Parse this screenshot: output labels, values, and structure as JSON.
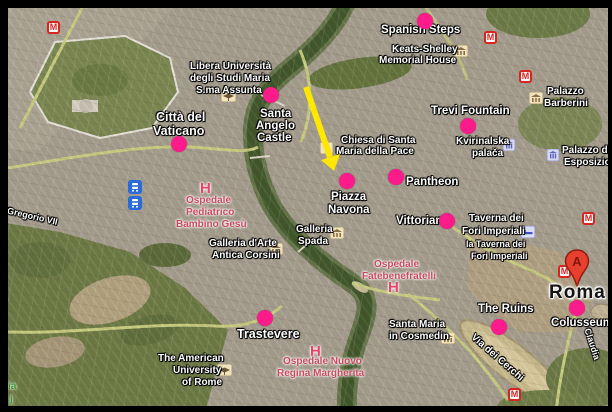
{
  "map": {
    "colors": {
      "marker": "#fb1b8b",
      "arrow": "#ffe800",
      "label": "#ffffff",
      "hospital": "#c84a5f",
      "hospital_h": "#e8436b",
      "park_label": "#3f9340",
      "metro": "#d62420",
      "city_label": "#151515"
    },
    "icon_glyphs": {
      "metro": "M",
      "pin": "A"
    },
    "dots": [
      {
        "name": "spanish-steps",
        "x": 425,
        "y": 21
      },
      {
        "name": "santa-angelo-castle",
        "x": 271,
        "y": 95
      },
      {
        "name": "trevi-fountain",
        "x": 468,
        "y": 126
      },
      {
        "name": "citta-del-vaticano",
        "x": 179,
        "y": 144
      },
      {
        "name": "piazza-navona",
        "x": 347,
        "y": 181
      },
      {
        "name": "pantheon",
        "x": 396,
        "y": 177
      },
      {
        "name": "vittoriano",
        "x": 447,
        "y": 221
      },
      {
        "name": "trastevere",
        "x": 265,
        "y": 318
      },
      {
        "name": "the-ruins",
        "x": 499,
        "y": 327
      },
      {
        "name": "colosseum",
        "x": 577,
        "y": 308
      }
    ],
    "labels": [
      {
        "text": "Spanish Steps",
        "x": 381,
        "y": 24,
        "cls": "s11"
      },
      {
        "text": "Keats-Shelley",
        "x": 392,
        "y": 44,
        "cls": "s10"
      },
      {
        "text": "Memorial House",
        "x": 379,
        "y": 55,
        "cls": "s10"
      },
      {
        "text": "Libera Università",
        "x": 190,
        "y": 61,
        "cls": "s10"
      },
      {
        "text": "degli Studi Maria",
        "x": 190,
        "y": 73,
        "cls": "s10"
      },
      {
        "text": "S.ma Assunta",
        "x": 196,
        "y": 85,
        "cls": "s10"
      },
      {
        "text": "Città del",
        "x": 156,
        "y": 110,
        "cls": "s12"
      },
      {
        "text": "Vaticano",
        "x": 153,
        "y": 124,
        "cls": "s12"
      },
      {
        "text": "Santa",
        "x": 260,
        "y": 108,
        "cls": "s11"
      },
      {
        "text": "Angelo",
        "x": 256,
        "y": 120,
        "cls": "s11"
      },
      {
        "text": "Castle",
        "x": 257,
        "y": 132,
        "cls": "s11"
      },
      {
        "text": "Chiesa di Santa",
        "x": 341,
        "y": 135,
        "cls": "s10"
      },
      {
        "text": "Maria della Pace",
        "x": 336,
        "y": 146,
        "cls": "s10"
      },
      {
        "text": "Trevi Fountain",
        "x": 431,
        "y": 105,
        "cls": "s11"
      },
      {
        "text": "Kvirinalska",
        "x": 456,
        "y": 136,
        "cls": "s10"
      },
      {
        "text": "palača",
        "x": 472,
        "y": 148,
        "cls": "s10"
      },
      {
        "text": "Palazzo",
        "x": 547,
        "y": 86,
        "cls": "s10"
      },
      {
        "text": "Barberini",
        "x": 544,
        "y": 98,
        "cls": "s10"
      },
      {
        "text": "Palazzo di",
        "x": 562,
        "y": 145,
        "cls": "s10"
      },
      {
        "text": "Esposizione",
        "x": 564,
        "y": 157,
        "cls": "s10"
      },
      {
        "text": "Piazza",
        "x": 331,
        "y": 191,
        "cls": "s11"
      },
      {
        "text": "Navona",
        "x": 328,
        "y": 204,
        "cls": "s11"
      },
      {
        "text": "Pantheon",
        "x": 406,
        "y": 176,
        "cls": "s11"
      },
      {
        "text": "Vittoriano",
        "x": 396,
        "y": 215,
        "cls": "s11"
      },
      {
        "text": "Taverna dei",
        "x": 469,
        "y": 213,
        "cls": "s10"
      },
      {
        "text": "Fori Imperiali",
        "x": 462,
        "y": 226,
        "cls": "s10"
      },
      {
        "text": "la Taverna dei",
        "x": 466,
        "y": 239,
        "cls": "s9"
      },
      {
        "text": "Fori Imperiali",
        "x": 471,
        "y": 251,
        "cls": "s9"
      },
      {
        "text": "Galleria",
        "x": 296,
        "y": 224,
        "cls": "s10"
      },
      {
        "text": "Spada",
        "x": 298,
        "y": 236,
        "cls": "s10"
      },
      {
        "text": "Galleria d'Arte",
        "x": 209,
        "y": 238,
        "cls": "s10"
      },
      {
        "text": "Antica Corsini",
        "x": 212,
        "y": 250,
        "cls": "s10"
      },
      {
        "text": "Santa Maria",
        "x": 389,
        "y": 319,
        "cls": "s10"
      },
      {
        "text": "in Cosmedin",
        "x": 389,
        "y": 331,
        "cls": "s10"
      },
      {
        "text": "The Ruins",
        "x": 478,
        "y": 303,
        "cls": "s11"
      },
      {
        "text": "Colusseum",
        "x": 551,
        "y": 317,
        "cls": "s11"
      },
      {
        "text": "Roma",
        "x": 549,
        "y": 282,
        "cls": "roma"
      },
      {
        "text": "Trastevere",
        "x": 237,
        "y": 327,
        "cls": "s12"
      },
      {
        "text": "The American",
        "x": 158,
        "y": 353,
        "cls": "s10"
      },
      {
        "text": "University",
        "x": 173,
        "y": 365,
        "cls": "s10"
      },
      {
        "text": "of Rome",
        "x": 182,
        "y": 377,
        "cls": "s10"
      },
      {
        "text": "Via Gregorio VII",
        "x": -7,
        "y": 202,
        "cls": "s9",
        "rot": 13
      },
      {
        "text": "Via dei Cerchi",
        "x": 476,
        "y": 332,
        "cls": "s10",
        "rot": 41
      },
      {
        "text": "Claudia",
        "x": 592,
        "y": 327,
        "cls": "s9",
        "rot": 72
      },
      {
        "text": "H",
        "x": 200,
        "y": 180,
        "cls": "hh"
      },
      {
        "text": "Ospedale",
        "x": 186,
        "y": 195,
        "cls": "red s10"
      },
      {
        "text": "Pediatrico",
        "x": 186,
        "y": 207,
        "cls": "red s10"
      },
      {
        "text": "Bambino Gesù",
        "x": 176,
        "y": 219,
        "cls": "red s10"
      },
      {
        "text": "Ospedale",
        "x": 374,
        "y": 259,
        "cls": "red s10"
      },
      {
        "text": "Fatebenefratelli",
        "x": 362,
        "y": 271,
        "cls": "red s10"
      },
      {
        "text": "H",
        "x": 388,
        "y": 279,
        "cls": "hh"
      },
      {
        "text": "H",
        "x": 310,
        "y": 343,
        "cls": "hh"
      },
      {
        "text": "Ospedale Nuovo",
        "x": 283,
        "y": 356,
        "cls": "red s10"
      },
      {
        "text": "Regina Margherita",
        "x": 277,
        "y": 368,
        "cls": "red s10"
      },
      {
        "text": "ia",
        "x": 8,
        "y": 381,
        "cls": "green s10"
      },
      {
        "text": "j",
        "x": 10,
        "y": 394,
        "cls": "green s10"
      }
    ],
    "icons": [
      {
        "type": "metro",
        "x": 47,
        "y": 21
      },
      {
        "type": "metro",
        "x": 484,
        "y": 31
      },
      {
        "type": "metro",
        "x": 519,
        "y": 70
      },
      {
        "type": "metro",
        "x": 582,
        "y": 212
      },
      {
        "type": "metro",
        "x": 558,
        "y": 265
      },
      {
        "type": "metro",
        "x": 508,
        "y": 388
      },
      {
        "type": "transit",
        "x": 128,
        "y": 180
      },
      {
        "type": "transit",
        "x": 128,
        "y": 196
      },
      {
        "type": "museum",
        "x": 454,
        "y": 45
      },
      {
        "type": "museum",
        "x": 529,
        "y": 92
      },
      {
        "type": "museum",
        "x": 330,
        "y": 227
      },
      {
        "type": "museum",
        "x": 269,
        "y": 243
      },
      {
        "type": "museum",
        "x": 441,
        "y": 332
      },
      {
        "type": "church",
        "x": 320,
        "y": 142
      },
      {
        "type": "university",
        "x": 221,
        "y": 90
      },
      {
        "type": "university",
        "x": 217,
        "y": 364
      },
      {
        "type": "lodging",
        "x": 521,
        "y": 226
      },
      {
        "type": "government",
        "x": 503,
        "y": 139
      },
      {
        "type": "government",
        "x": 547,
        "y": 149
      },
      {
        "type": "pin-a",
        "x": 564,
        "y": 249
      }
    ],
    "arrow": {
      "x1": 306,
      "y1": 87,
      "x2": 330,
      "y2": 157,
      "head_points": "334,171 340,154 321,160"
    }
  }
}
